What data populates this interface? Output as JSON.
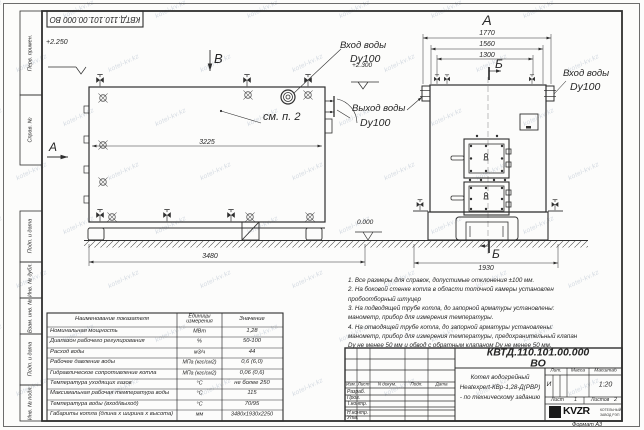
{
  "watermark": "kotel-kv.kz",
  "stamp_top": {
    "doc_number": "КВТД.110.101.00.000 ВО"
  },
  "margin": {
    "box1": "Перв. примен.",
    "box2": "Справ. №",
    "box3": "Подп. и дата",
    "box4": "Инв. № дубл.",
    "box5": "Взам. инв. №",
    "box6": "Подп. и дата",
    "box7": "Инв. № подл."
  },
  "views": {
    "side": {
      "view_label": "В",
      "section_label": "А",
      "elev_top": "+2.250",
      "elev_zero": "0.000",
      "dim_inner": "3225",
      "dim_length": "3480",
      "callout_note": "см. п. 2",
      "inlet_title": "Вход воды",
      "inlet_dn": "Dy100",
      "outlet_title": "Выход воды",
      "outlet_dn": "Dy100"
    },
    "front": {
      "view_label": "А",
      "elev_top": "+2.300",
      "dim_1": "1770",
      "dim_2": "1560",
      "dim_3": "1300",
      "dim_width": "1930",
      "section_top": "Б",
      "section_bottom": "Б",
      "inlet_title": "Вход воды",
      "inlet_dn": "Dy100"
    }
  },
  "notes": {
    "lines": [
      "1.  Все размеры для справок, допустимые отклонения ±100 мм.",
      "2.  На боковой стенке котла в области топочной камеры установлен",
      "пробоотборный штуцер",
      "3.  На подводящей трубе котла, до запорной арматуры установлены:",
      "манометр, прибор для измерения температуры.",
      "4.  На отводящей трубе котла, до запорной арматуры установлены:",
      "манометр, прибор для измерения температуры, предохранительный клапан",
      "Dу не менее 50 мм и обвод с обратным клапаном Dу не менее 50 мм."
    ]
  },
  "parameters": {
    "headers": [
      "Наименование показателя",
      "Единицы измерения",
      "Значение"
    ],
    "rows": [
      [
        "Номинальная мощность",
        "МВт",
        "1,28"
      ],
      [
        "Диапазон рабочего регулирования",
        "%",
        "50-100"
      ],
      [
        "Расход воды",
        "м3/ч",
        "44"
      ],
      [
        "Рабочее давление воды",
        "МПа (кгс/см2)",
        "0,6 (6,0)"
      ],
      [
        "Гидравлическое сопротивление котла",
        "МПа (кгс/см2)",
        "0,06 (0,6)"
      ],
      [
        "Температура уходящих газов",
        "°С",
        "не более 250"
      ],
      [
        "Максимальная рабочая температура воды",
        "°С",
        "115"
      ],
      [
        "Температура воды (вход/выход)",
        "°С",
        "70/95"
      ],
      [
        "Габариты котла (длина х ширина х высота)",
        "мм",
        "3480х1930х2250"
      ]
    ]
  },
  "titleblock": {
    "doc_number": "КВТД.110.101.00.000 ВО",
    "rev_cols": [
      "Изм.",
      "Лист",
      "N докум.",
      "Подп.",
      "Дата"
    ],
    "roles": [
      "Разраб.",
      "Пров.",
      "Т.контр.",
      "Н.контр.",
      "Утв."
    ],
    "product_line1": "Котел водогрейный",
    "product_line2": "Heatexpert-КВр-1,28-Д(РВР)",
    "product_line3": "- по техническому заданию",
    "lit_label": "Лит.",
    "mass_label": "Масса",
    "scale_label": "Масштаб",
    "lit_value": "И",
    "scale_value": "1:20",
    "sheet_label": "Лист",
    "sheet_value": "1",
    "sheets_label": "Листов",
    "sheets_value": "2",
    "logo_text": "KVZR",
    "logo_sub1": "КОТЕЛЬНЫЙ",
    "logo_sub2": "ЗАВОД РЭП",
    "format_label": "Формат А3"
  }
}
